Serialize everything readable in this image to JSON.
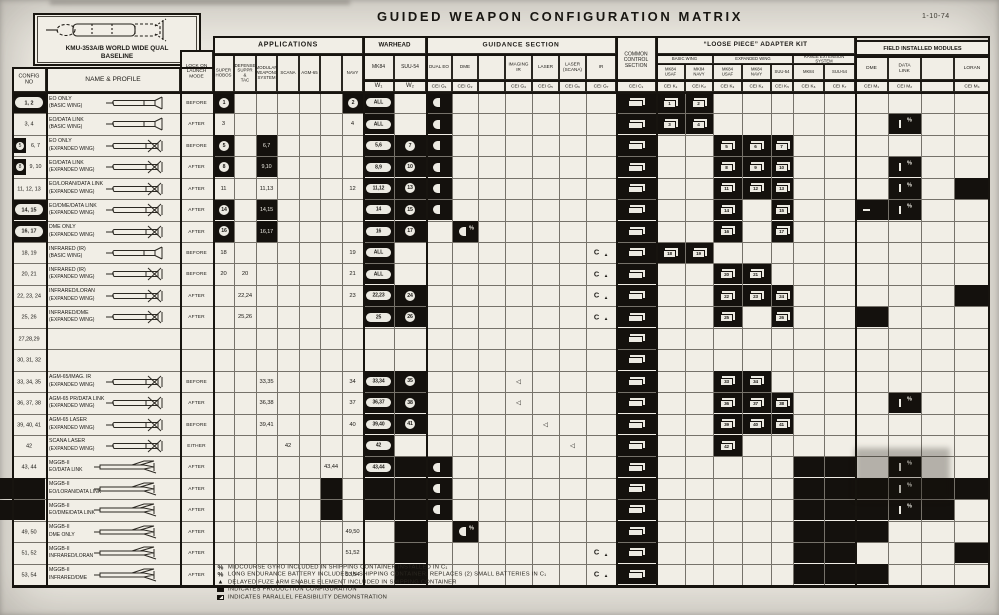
{
  "title": "GUIDED WEAPON CONFIGURATION MATRIX",
  "date": "1-10-74",
  "baseline": {
    "line1": "KMU-353A/B WORLD WIDE QUAL",
    "line2": "BASELINE"
  },
  "header": {
    "config": "CONFIG\nNO",
    "name": "NAME & PROFILE",
    "launch": "LOCK ON\nLAUNCH\nMODE",
    "groups": {
      "applications": "APPLICATIONS",
      "warhead": "WARHEAD",
      "guidance": "GUIDANCE SECTION",
      "common": "COMMON\nCONTROL\nSECTION",
      "loose": "“LOOSE PIECE” ADAPTER KIT",
      "field": "FIELD INSTALLED MODULES"
    },
    "app_cols": [
      "SUPER\nHOBOS",
      "DEFENSE\nSUPPR\n&\nTAC",
      "MODULAR\nWEAPONS\nSYSTEM",
      "SCANA",
      "AGM-65",
      "",
      "NAVY"
    ],
    "warhead_cols": [
      "MK84",
      "SUU-54"
    ],
    "warhead_cei": [
      "W₁",
      "W₂"
    ],
    "guidance_cols": [
      "DUAL EO",
      "DME",
      "",
      "IMAGING\nIR",
      "LASER",
      "LASER\n(SCANA)",
      "IR"
    ],
    "guidance_cei": [
      "CEI G₁",
      "CEI G₂",
      "",
      "CEI G₄",
      "CEI G₅",
      "CEI G₆",
      "CEI G₇"
    ],
    "common_cei": "CEI C₁",
    "loose_groups": [
      {
        "label": "BASIC WING",
        "cols": [
          "MK84\nUSAF",
          "MK84\nNAVY"
        ],
        "cei": [
          "CEI K₁",
          "CEI K₂"
        ]
      },
      {
        "label": "EXPANDED WING",
        "cols": [
          "MK84\nUSAF",
          "MK84\nNAVY",
          "SUU-54"
        ],
        "cei": [
          "CEI K₃",
          "CEI K₄",
          "CEI K₅"
        ]
      },
      {
        "label": "RANGE EXTENSION\nSYSTEM",
        "cols": [
          "MK84",
          "SUU-54"
        ],
        "cei": [
          "CEI K₆",
          "CEI K₇"
        ]
      }
    ],
    "field_cols": [
      "DME",
      "DATA\nLINK",
      "",
      "LORAN"
    ],
    "field_cei": [
      "CEI M₁",
      "CEI M₂",
      "",
      "CEI M₄"
    ]
  },
  "rows": [
    {
      "config": "1, 2",
      "style": "oval",
      "name": "EO ONLY",
      "sub": "(BASIC WING)",
      "wing": "basic",
      "launch": "BEFORE",
      "marks": [
        [
          "A1",
          "circle",
          "1"
        ],
        [
          "A7",
          "circle",
          "2"
        ],
        [
          "W1",
          "pill",
          "ALL"
        ],
        [
          "G1",
          "half"
        ],
        [
          "C1",
          "boxe"
        ],
        [
          "K1",
          "box",
          "1"
        ],
        [
          "K2",
          "box",
          "2"
        ]
      ]
    },
    {
      "config": "3, 4",
      "style": "plain",
      "name": "EO/DATA LINK",
      "sub": "(BASIC WING)",
      "wing": "basic",
      "launch": "AFTER",
      "marks": [
        [
          "A1",
          "num",
          "3"
        ],
        [
          "A7",
          "num",
          "4"
        ],
        [
          "W1",
          "pill",
          "ALL"
        ],
        [
          "G1",
          "half"
        ],
        [
          "C1",
          "boxe"
        ],
        [
          "K1",
          "box",
          "3"
        ],
        [
          "K2",
          "box",
          "4"
        ],
        [
          "M2",
          "barpct"
        ]
      ]
    },
    {
      "config": "5, 6, 7",
      "style": "chip",
      "name": "EO ONLY",
      "sub": "(EXPANDED WING)",
      "wing": "exp",
      "launch": "BEFORE",
      "marks": [
        [
          "A1",
          "circle",
          "5"
        ],
        [
          "A3",
          "wnum",
          "6,7"
        ],
        [
          "W1",
          "pill",
          "5,6"
        ],
        [
          "W2",
          "circle",
          "7"
        ],
        [
          "G1",
          "half"
        ],
        [
          "C1",
          "boxe"
        ],
        [
          "K3",
          "box",
          "5"
        ],
        [
          "K4",
          "box",
          "6"
        ],
        [
          "K5",
          "box",
          "7"
        ]
      ]
    },
    {
      "config": "8, 9, 10",
      "style": "chip",
      "name": "EO/DATA LINK",
      "sub": "(EXPANDED WING)",
      "wing": "exp",
      "launch": "AFTER",
      "marks": [
        [
          "A1",
          "circle",
          "8"
        ],
        [
          "A3",
          "wnum",
          "9,10"
        ],
        [
          "W1",
          "pill",
          "8,9"
        ],
        [
          "W2",
          "circle",
          "10"
        ],
        [
          "G1",
          "half"
        ],
        [
          "C1",
          "boxe"
        ],
        [
          "K3",
          "box",
          "8"
        ],
        [
          "K4",
          "box",
          "9"
        ],
        [
          "K5",
          "box",
          "10"
        ],
        [
          "M2",
          "barpct"
        ]
      ]
    },
    {
      "config": "11, 12, 13",
      "style": "plain",
      "name": "EO/LORAN/DATA LINK",
      "sub": "(EXPANDED WING)",
      "wing": "exp",
      "launch": "AFTER",
      "marks": [
        [
          "A1",
          "num",
          "11"
        ],
        [
          "A3",
          "num",
          "11,13"
        ],
        [
          "A7",
          "num",
          "12"
        ],
        [
          "W1",
          "pill",
          "11,12"
        ],
        [
          "W2",
          "circle",
          "13"
        ],
        [
          "G1",
          "half"
        ],
        [
          "C1",
          "boxe"
        ],
        [
          "K3",
          "box",
          "11"
        ],
        [
          "K4",
          "box",
          "12"
        ],
        [
          "K5",
          "box",
          "13"
        ],
        [
          "M2",
          "barpct"
        ],
        [
          "M4",
          "blk"
        ]
      ]
    },
    {
      "config": "14, 15",
      "style": "oval",
      "name": "EO/DME/DATA LINK",
      "sub": "(EXPANDED WING)",
      "wing": "exp",
      "launch": "AFTER",
      "marks": [
        [
          "A1",
          "circle",
          "14"
        ],
        [
          "A3",
          "wnum",
          "14,15"
        ],
        [
          "W1",
          "pill",
          "14"
        ],
        [
          "W2",
          "circle",
          "15"
        ],
        [
          "G1",
          "half"
        ],
        [
          "C1",
          "boxe"
        ],
        [
          "K3",
          "box",
          "14"
        ],
        [
          "K5",
          "box",
          "15"
        ],
        [
          "M1",
          "blkdash"
        ],
        [
          "M2",
          "barpct"
        ]
      ]
    },
    {
      "config": "16, 17",
      "style": "oval",
      "name": "DME ONLY",
      "sub": "(EXPANDED WING)",
      "wing": "exp",
      "launch": "AFTER",
      "marks": [
        [
          "A1",
          "circle",
          "16"
        ],
        [
          "A3",
          "wnum",
          "16,17"
        ],
        [
          "W1",
          "pill",
          "16"
        ],
        [
          "W2",
          "circle",
          "17"
        ],
        [
          "G2",
          "halfpct"
        ],
        [
          "C1",
          "boxe"
        ],
        [
          "K3",
          "box",
          "16"
        ],
        [
          "K5",
          "box",
          "17"
        ]
      ]
    },
    {
      "config": "18, 19",
      "style": "plain",
      "name": "INFRARED (IR)",
      "sub": "(BASIC WING)",
      "wing": "basic",
      "launch": "BEFORE",
      "marks": [
        [
          "A1",
          "num",
          "18"
        ],
        [
          "A7",
          "num",
          "19"
        ],
        [
          "W1",
          "pill",
          "ALL"
        ],
        [
          "G7",
          "iratri"
        ],
        [
          "C1",
          "boxe"
        ],
        [
          "K1",
          "box",
          "18"
        ],
        [
          "K2",
          "box",
          "19"
        ]
      ]
    },
    {
      "config": "20, 21",
      "style": "plain",
      "name": "INFRARED (IR)",
      "sub": "(EXPANDED WING)",
      "wing": "exp",
      "launch": "BEFORE",
      "marks": [
        [
          "A1",
          "num",
          "20"
        ],
        [
          "A2",
          "num",
          "20"
        ],
        [
          "A7",
          "num",
          "21"
        ],
        [
          "W1",
          "pill",
          "ALL"
        ],
        [
          "G7",
          "iratri"
        ],
        [
          "C1",
          "boxe"
        ],
        [
          "K3",
          "box",
          "20"
        ],
        [
          "K4",
          "box",
          "21"
        ]
      ]
    },
    {
      "config": "22, 23, 24",
      "style": "plain",
      "name": "INFRARED/LORAN",
      "sub": "(EXPANDED WING)",
      "wing": "exp",
      "launch": "AFTER",
      "marks": [
        [
          "A2",
          "num",
          "22,24"
        ],
        [
          "A7",
          "num",
          "23"
        ],
        [
          "W1",
          "pill",
          "22,23"
        ],
        [
          "W2",
          "circle",
          "24"
        ],
        [
          "G7",
          "iratri"
        ],
        [
          "C1",
          "boxe"
        ],
        [
          "K3",
          "box",
          "22"
        ],
        [
          "K4",
          "box",
          "23"
        ],
        [
          "K5",
          "box",
          "24"
        ],
        [
          "M4",
          "blk"
        ]
      ]
    },
    {
      "config": "25, 26",
      "style": "plain",
      "name": "INFRARED/DME",
      "sub": "(EXPANDED WING)",
      "wing": "exp",
      "launch": "AFTER",
      "marks": [
        [
          "A2",
          "num",
          "25,26"
        ],
        [
          "W1",
          "pill",
          "25"
        ],
        [
          "W2",
          "circle",
          "26"
        ],
        [
          "G7",
          "iratri"
        ],
        [
          "C1",
          "boxe"
        ],
        [
          "K3",
          "box",
          "25"
        ],
        [
          "K5",
          "box",
          "26"
        ],
        [
          "M1",
          "blk"
        ]
      ]
    },
    {
      "config": "27,28,29",
      "style": "plain",
      "name": "",
      "sub": "",
      "wing": "",
      "launch": "",
      "marks": [
        [
          "C1",
          "boxe"
        ]
      ]
    },
    {
      "config": "30, 31, 32",
      "style": "plain",
      "name": "",
      "sub": "",
      "wing": "",
      "launch": "",
      "marks": [
        [
          "C1",
          "boxe"
        ]
      ]
    },
    {
      "config": "33, 34, 35",
      "style": "plain",
      "name": "AGM-65/IMAG. IR",
      "sub": "(EXPANDED WING)",
      "wing": "exp",
      "launch": "BEFORE",
      "marks": [
        [
          "A3",
          "num",
          "33,35"
        ],
        [
          "A7",
          "num",
          "34"
        ],
        [
          "W1",
          "pill",
          "33,34"
        ],
        [
          "W2",
          "circle",
          "35"
        ],
        [
          "G4",
          "tri"
        ],
        [
          "C1",
          "boxe"
        ],
        [
          "K3",
          "box",
          "33"
        ],
        [
          "K4",
          "box",
          "34"
        ]
      ]
    },
    {
      "config": "36, 37, 38",
      "style": "plain",
      "name": "AGM-65 PR/DATA LINK",
      "sub": "(EXPANDED WING)",
      "wing": "exp",
      "launch": "AFTER",
      "marks": [
        [
          "A3",
          "num",
          "36,38"
        ],
        [
          "A7",
          "num",
          "37"
        ],
        [
          "W1",
          "pill",
          "36,37"
        ],
        [
          "W2",
          "circle",
          "38"
        ],
        [
          "G4",
          "tri"
        ],
        [
          "C1",
          "boxe"
        ],
        [
          "K3",
          "box",
          "36"
        ],
        [
          "K4",
          "box",
          "37"
        ],
        [
          "K5",
          "box",
          "38"
        ],
        [
          "M2",
          "barpct"
        ]
      ]
    },
    {
      "config": "39, 40, 41",
      "style": "plain",
      "name": "AGM-65 LASER",
      "sub": "(EXPANDED WING)",
      "wing": "exp",
      "launch": "BEFORE",
      "marks": [
        [
          "A3",
          "num",
          "39,41"
        ],
        [
          "A7",
          "num",
          "40"
        ],
        [
          "W1",
          "pill",
          "39,40"
        ],
        [
          "W2",
          "circle",
          "41"
        ],
        [
          "G5",
          "tri"
        ],
        [
          "C1",
          "boxe"
        ],
        [
          "K3",
          "box",
          "39"
        ],
        [
          "K4",
          "box",
          "40"
        ],
        [
          "K5",
          "box",
          "41"
        ]
      ]
    },
    {
      "config": "42",
      "style": "plain",
      "name": "SCANA LASER",
      "sub": "(EXPANDED WING)",
      "wing": "exp",
      "launch": "EITHER",
      "marks": [
        [
          "A4",
          "num",
          "42"
        ],
        [
          "W1",
          "pill",
          "42"
        ],
        [
          "G6",
          "tri"
        ],
        [
          "C1",
          "boxe"
        ],
        [
          "K3",
          "box",
          "42"
        ]
      ]
    },
    {
      "config": "43, 44",
      "style": "plain",
      "name": "MGGB-II",
      "sub": "EO/DATA LINK",
      "wing": "mggb",
      "launch": "AFTER",
      "marks": [
        [
          "A6",
          "num",
          "43,44"
        ],
        [
          "W1",
          "pill",
          "43,44"
        ],
        [
          "W2",
          "blk"
        ],
        [
          "G1",
          "half"
        ],
        [
          "C1",
          "boxe"
        ],
        [
          "K6",
          "blk"
        ],
        [
          "K7",
          "blk"
        ],
        [
          "M2",
          "barpct"
        ]
      ]
    },
    {
      "config": "",
      "style": "blackout",
      "name": "MGGB-II",
      "sub": "EO/LORAN/DATA LINK",
      "wing": "mggb",
      "launch": "AFTER",
      "marks": [
        [
          "A6",
          "blk"
        ],
        [
          "W1",
          "blk"
        ],
        [
          "W2",
          "blk"
        ],
        [
          "G1",
          "half"
        ],
        [
          "C1",
          "boxe"
        ],
        [
          "K6",
          "blk"
        ],
        [
          "K7",
          "blk"
        ],
        [
          "M1",
          "blk"
        ],
        [
          "M2",
          "barpct"
        ],
        [
          "M3",
          "blk"
        ],
        [
          "M4",
          "blk"
        ]
      ]
    },
    {
      "config": "",
      "style": "blackout",
      "name": "MGGB-II",
      "sub": "EO/DME/DATA LINK",
      "wing": "mggb",
      "launch": "AFTER",
      "marks": [
        [
          "A6",
          "blk"
        ],
        [
          "W1",
          "blk"
        ],
        [
          "W2",
          "blk"
        ],
        [
          "G1",
          "half"
        ],
        [
          "C1",
          "boxe"
        ],
        [
          "K6",
          "blk"
        ],
        [
          "K7",
          "blk"
        ],
        [
          "M1",
          "blk"
        ],
        [
          "M2",
          "barpct"
        ],
        [
          "M3",
          "blk"
        ]
      ]
    },
    {
      "config": "49, 50",
      "style": "plain",
      "name": "MGGB-II",
      "sub": "DME ONLY",
      "wing": "mggb",
      "launch": "AFTER",
      "marks": [
        [
          "A7",
          "num",
          "49,50"
        ],
        [
          "W2",
          "blk"
        ],
        [
          "G2",
          "halfpct"
        ],
        [
          "C1",
          "boxe"
        ],
        [
          "K6",
          "blk"
        ],
        [
          "K7",
          "blk"
        ],
        [
          "M1",
          "blk"
        ]
      ]
    },
    {
      "config": "51, 52",
      "style": "plain",
      "name": "MGGB-II",
      "sub": "INFRARED/LORAN",
      "wing": "mggb",
      "launch": "AFTER",
      "marks": [
        [
          "A7",
          "num",
          "51,52"
        ],
        [
          "W2",
          "blk"
        ],
        [
          "G7",
          "iratri"
        ],
        [
          "C1",
          "boxe"
        ],
        [
          "K6",
          "blk"
        ],
        [
          "K7",
          "blk"
        ],
        [
          "M4",
          "blk"
        ]
      ]
    },
    {
      "config": "53, 54",
      "style": "plain",
      "name": "MGGB-II",
      "sub": "INFRARED/DME",
      "wing": "mggb",
      "launch": "AFTER",
      "marks": [
        [
          "A7",
          "num",
          "53,54"
        ],
        [
          "W2",
          "blk"
        ],
        [
          "G7",
          "iratri"
        ],
        [
          "C1",
          "boxe"
        ],
        [
          "K6",
          "blk"
        ],
        [
          "K7",
          "blk"
        ],
        [
          "M1",
          "blk"
        ]
      ]
    }
  ],
  "legend": [
    {
      "sym": "pct",
      "text": "MIDCOURSE GYRO INCLUDED IN SHIPPING CONTAINER INSTALLED IN C₁"
    },
    {
      "sym": "pct",
      "text": "LONG ENDURANCE BATTERY INCLUDED IN SHIPPING CONTAINER. REPLACES (2) SMALL BATTERIES IN C₁"
    },
    {
      "sym": "tri",
      "text": "DELAYED FUZE ARM ENABLE ELEMENT INCLUDED IN SHIPPING CONTAINER"
    },
    {
      "sym": "sq",
      "text": "INDICATES  PRODUCTION  CONFIGURATION"
    },
    {
      "sym": "sqh",
      "text": "INDICATES  PARALLEL  FEASIBILITY  DEMONSTRATION"
    }
  ]
}
